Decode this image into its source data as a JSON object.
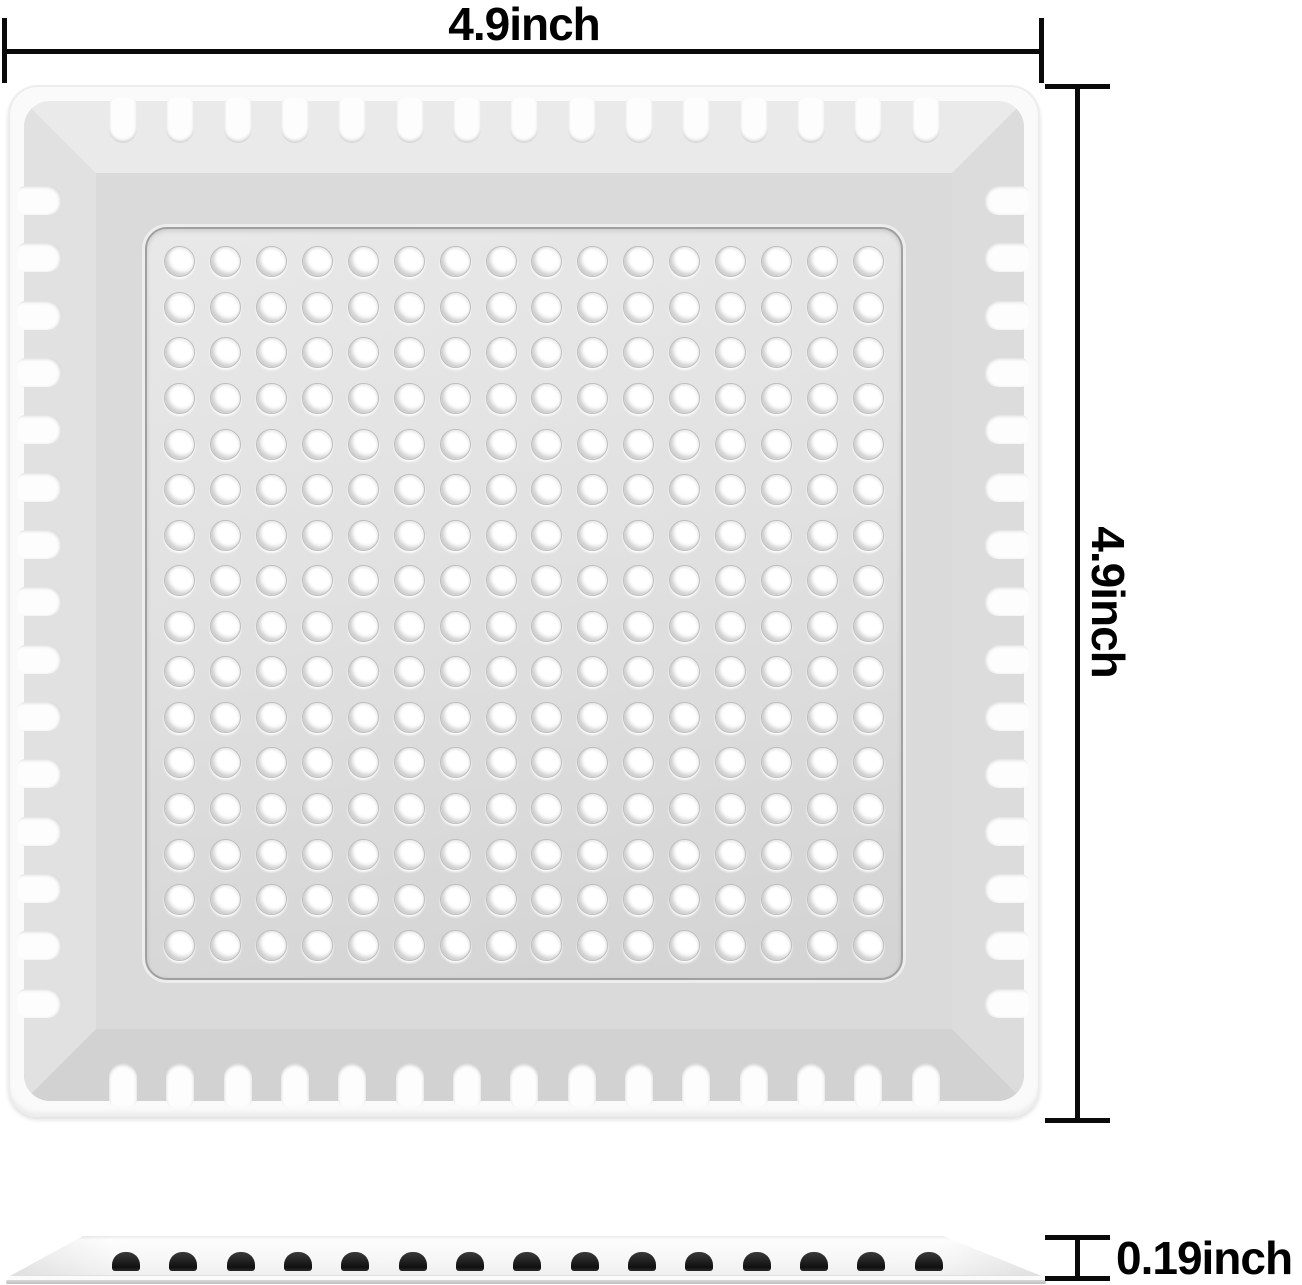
{
  "dimensions": {
    "width": "4.9inch",
    "height": "4.9inch",
    "thickness": "0.19inch"
  },
  "top_view": {
    "hole_rows": 16,
    "hole_cols": 16,
    "edge_slots_per_side": 15
  },
  "side_view": {
    "slot_count": 15
  },
  "colors": {
    "background": "#ffffff",
    "dimension_line": "#0a0a0a",
    "label_text": "#000000",
    "tray_body": "#fafafa",
    "panel_surface": "#dcdcdc",
    "hole_fill": "#ffffff",
    "side_slot_dark": "#1a1a1a"
  }
}
